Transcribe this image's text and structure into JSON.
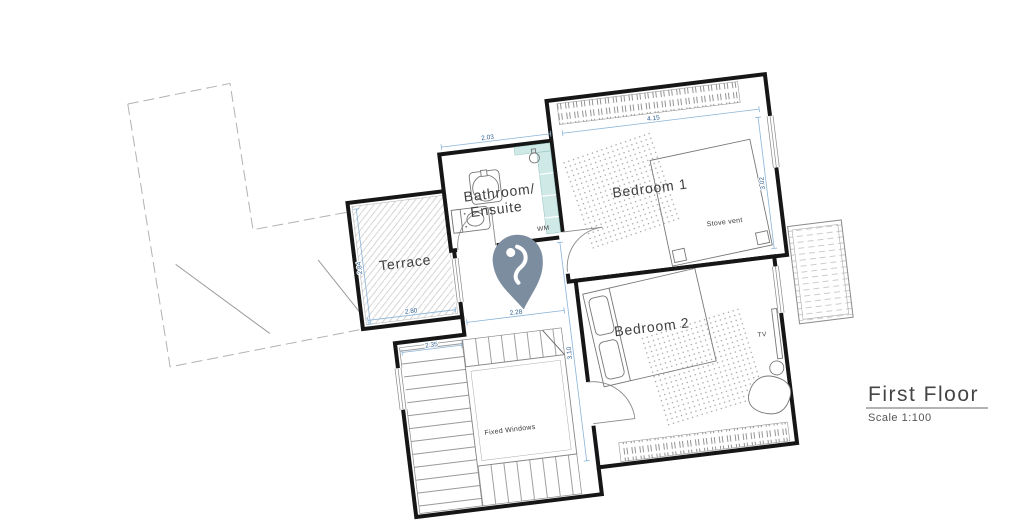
{
  "title_block": {
    "title": "First Floor",
    "scale": "Scale 1:100"
  },
  "rooms": {
    "terrace": {
      "label": "Terrace"
    },
    "bathroom": {
      "label_line1": "Bathroom/",
      "label_line2": "Ensuite"
    },
    "bedroom1": {
      "label": "Bedroom 1",
      "annotation": "Stove vent"
    },
    "bedroom2": {
      "label": "Bedroom 2",
      "annotation": "TV"
    },
    "stairwell": {
      "label": "Fixed Windows"
    }
  },
  "fixtures": {
    "washing_machine": "WM"
  },
  "dimensions": {
    "bathroom_width": "2.03",
    "bedroom1_width": "4.15",
    "bedroom1_depth": "3.02",
    "terrace_depth": "2.84",
    "terrace_width": "2.80",
    "stairs_width": "2.35",
    "landing_depth": "3.10",
    "landing_width": "2.28"
  },
  "marker": {
    "type": "location-pin"
  },
  "colors": {
    "wall": "#161616",
    "pin": "#7c8da0",
    "dimension_line": "#8ab4d8",
    "dimension_text": "#2f5f8f",
    "shower_glass": "#cfe9e7"
  }
}
